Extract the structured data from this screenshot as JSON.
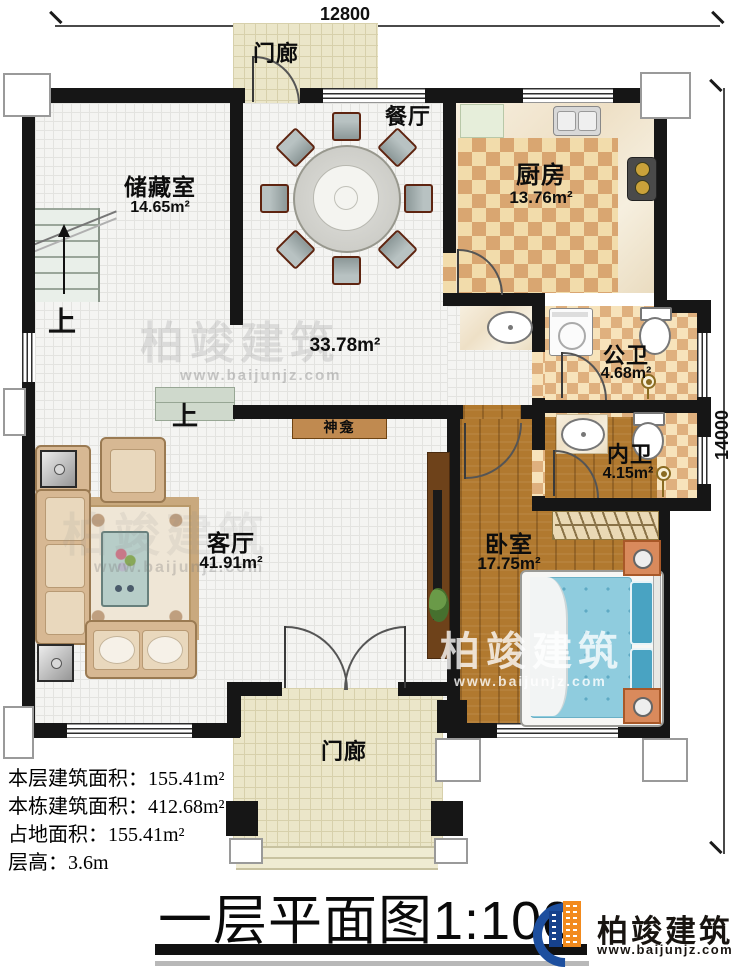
{
  "dimensions": {
    "width_label": "12800",
    "height_label": "14000"
  },
  "title": {
    "text": "一层平面图1:100"
  },
  "rooms": {
    "porch_top": {
      "name": "门廊"
    },
    "storage": {
      "name": "储藏室",
      "area": "14.65m²"
    },
    "dining": {
      "name": "餐厅"
    },
    "kitchen": {
      "name": "厨房",
      "area": "13.76m²"
    },
    "hall": {
      "area": "33.78m²"
    },
    "public_bath": {
      "name": "公卫",
      "area": "4.68m²"
    },
    "ensuite_bath": {
      "name": "内卫",
      "area": "4.15m²"
    },
    "bedroom": {
      "name": "卧室",
      "area": "17.75m²"
    },
    "living": {
      "name": "客厅",
      "area": "41.91m²"
    },
    "porch_bottom": {
      "name": "门廊"
    },
    "shrine": {
      "name": "神龛"
    }
  },
  "stairs": {
    "up": "上"
  },
  "floor_step": {
    "up": "上"
  },
  "info": {
    "line1_label": "本层建筑面积：",
    "line1_value": "155.41m²",
    "line2_label": "本栋建筑面积：",
    "line2_value": "412.68m²",
    "line3_label": "占地面积：",
    "line3_value": "155.41m²",
    "line4_label": "层高：",
    "line4_value": "3.6m"
  },
  "brand": {
    "name": "柏竣建筑",
    "url": "www.baijunjz.com"
  },
  "watermark": {
    "name": "柏竣建筑",
    "url": "www.baijunjz.com"
  },
  "colors": {
    "wall": "#161616",
    "brand_blue": "#1d4f9f",
    "brand_orange": "#f28a1d",
    "kitchen_tile_dark": "#d9a671",
    "kitchen_tile_light": "#f2dcab",
    "wood_floor": "#b1792f",
    "mattress_blue": "#8ecbdd",
    "shrine_bar": "#c08a50",
    "porch_floor": "#ebe6c9"
  }
}
